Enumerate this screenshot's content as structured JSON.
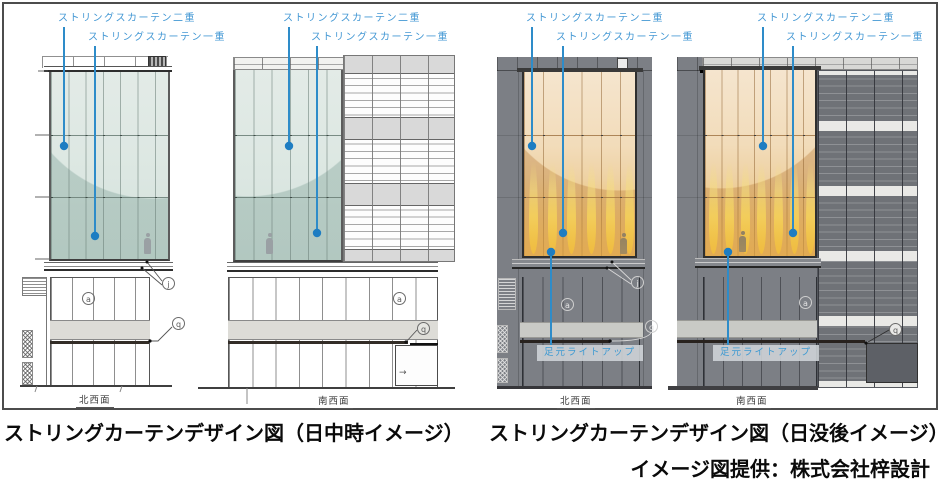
{
  "figure": {
    "day": {
      "caption": "ストリングカーテンデザイン図（日中時イメージ）",
      "views": [
        "北西面",
        "南西面"
      ]
    },
    "night": {
      "caption": "ストリングカーテンデザイン図（日没後イメージ）",
      "views": [
        "北西面",
        "南西面"
      ]
    },
    "credit": "イメージ図提供：株式会社梓設計"
  },
  "annotations": {
    "curtain_double": "ストリングスカーテン二重",
    "curtain_single": "ストリングスカーテン一重",
    "foot_lightup": "足元ライトアップ"
  },
  "markers": {
    "a": "a",
    "j": "j",
    "q": "q",
    "arrow": "→"
  },
  "colors": {
    "annotation_blue": "#3f96d2",
    "day_glass": "#dce7e2",
    "night_glow": "#f0c75f",
    "surround_gray": "#7c7f85"
  }
}
